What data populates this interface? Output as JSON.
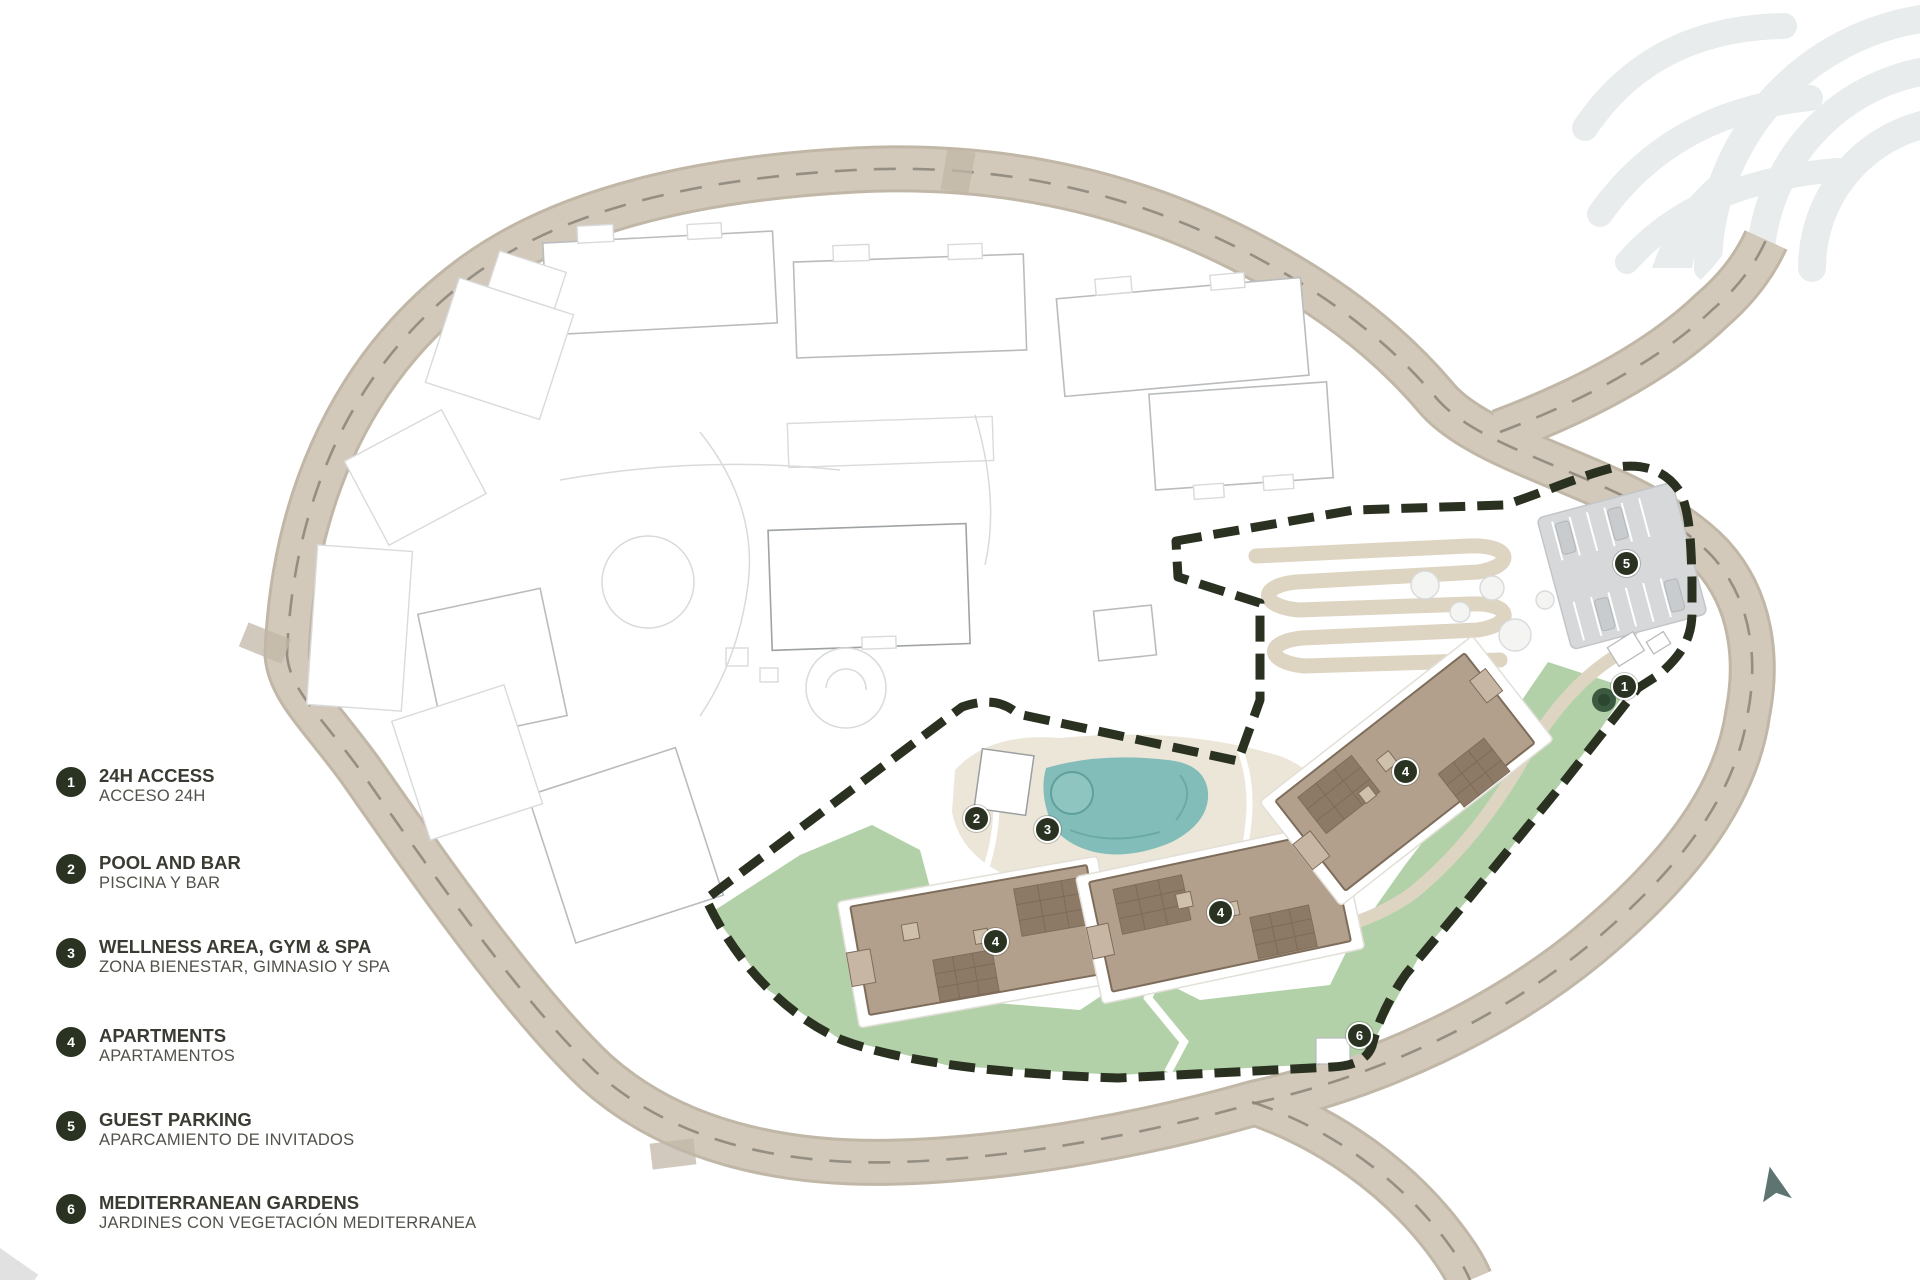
{
  "legend": {
    "items": [
      {
        "number": "1",
        "title": "24H ACCESS",
        "subtitle": "ACCESO 24H",
        "cy": 782
      },
      {
        "number": "2",
        "title": "POOL AND BAR",
        "subtitle": "PISCINA Y BAR",
        "cy": 869
      },
      {
        "number": "3",
        "title": "WELLNESS AREA, GYM & SPA",
        "subtitle": "ZONA BIENESTAR, GIMNASIO Y SPA",
        "cy": 953
      },
      {
        "number": "4",
        "title": "APARTMENTS",
        "subtitle": "APARTAMENTOS",
        "cy": 1042
      },
      {
        "number": "5",
        "title": "GUEST PARKING",
        "subtitle": "APARCAMIENTO DE INVITADOS",
        "cy": 1126
      },
      {
        "number": "6",
        "title": "MEDITERRANEAN GARDENS",
        "subtitle": "JARDINES CON VEGETACIÓN MEDITERRANEA",
        "cy": 1209
      }
    ]
  },
  "map": {
    "markers": [
      {
        "number": "1",
        "x": 1624,
        "y": 686,
        "label": "24H ACCESS"
      },
      {
        "number": "2",
        "x": 976,
        "y": 818,
        "label": "POOL AND BAR"
      },
      {
        "number": "3",
        "x": 1047,
        "y": 829,
        "label": "WELLNESS AREA, GYM & SPA"
      },
      {
        "number": "4",
        "x": 995,
        "y": 941,
        "label": "APARTMENTS"
      },
      {
        "number": "4",
        "x": 1220,
        "y": 912,
        "label": "APARTMENTS"
      },
      {
        "number": "4",
        "x": 1405,
        "y": 771,
        "label": "APARTMENTS"
      },
      {
        "number": "5",
        "x": 1626,
        "y": 563,
        "label": "GUEST PARKING"
      },
      {
        "number": "6",
        "x": 1359,
        "y": 1035,
        "label": "MEDITERRANEAN GARDENS"
      }
    ]
  },
  "colors": {
    "road": "#d2c9ba",
    "roadedge": "#c1b7a7",
    "roaddash": "#8b8478",
    "boundary": "#2a3120",
    "lawn": "#b3d1a8",
    "pool": "#82bdb9",
    "pooldark": "#5fa09c",
    "building": "#b2a08d",
    "buildingdark": "#8d7a66",
    "buildingstroke": "#7f6d5c",
    "parking": "#d6d8da",
    "faint": "#b9bcbe",
    "fainter": "#d8dadb",
    "deck": "#ece6d9",
    "serp": "#ded4c2",
    "marker": "#2a3322",
    "legendtitle": "#3b3b34",
    "legendsub": "#52524b",
    "watermark": "#e8eced",
    "tree": "#3c5a40",
    "compass": "#5d7471"
  }
}
